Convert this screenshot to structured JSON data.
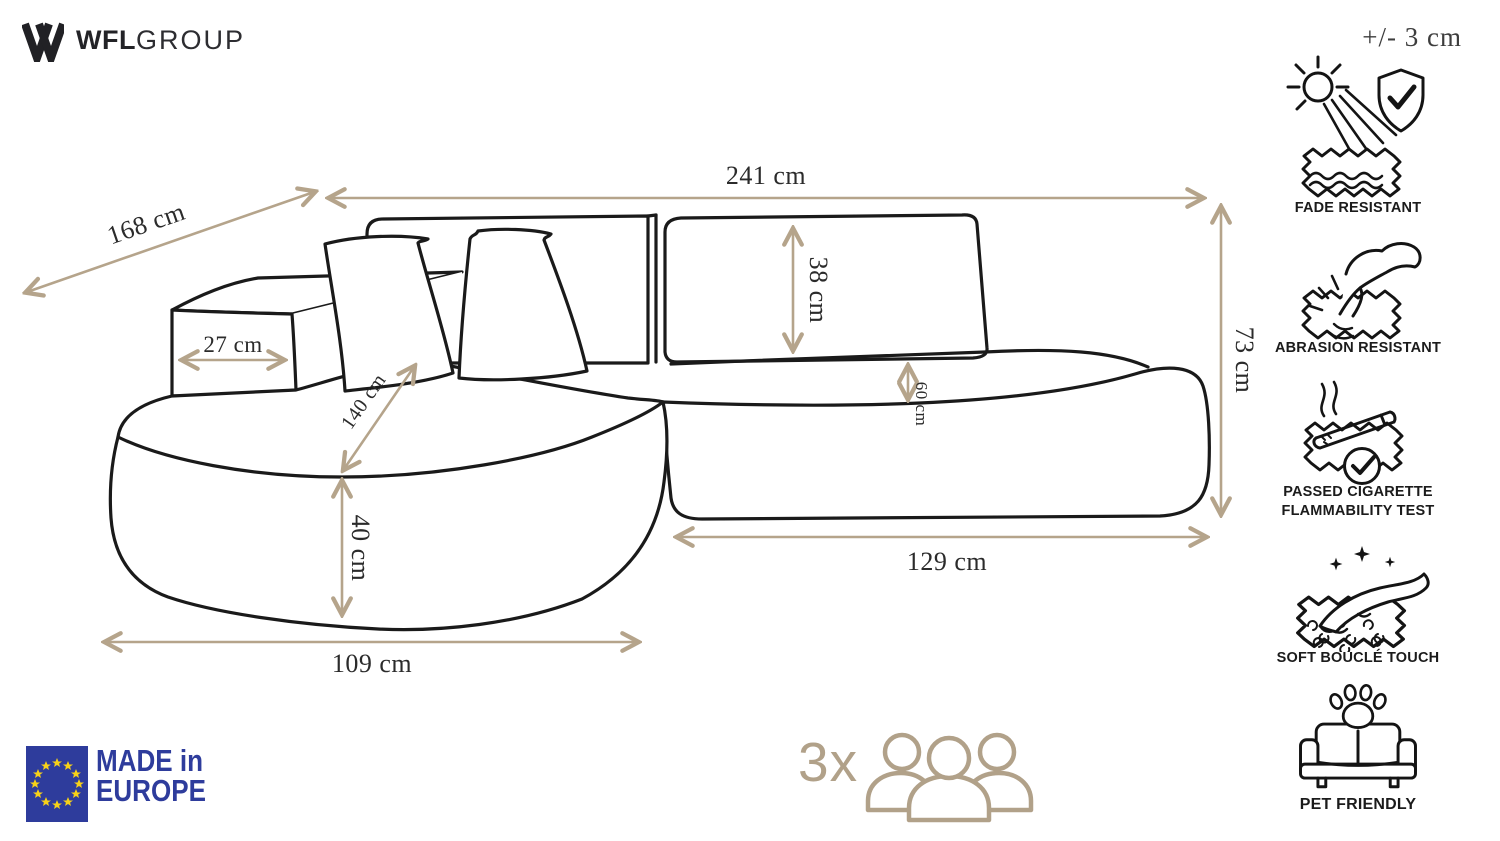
{
  "brand": {
    "name_bold": "WFL",
    "name_light": "GROUP",
    "mark": "w-logo"
  },
  "tolerance_note": "+/- 3 cm",
  "dimensions": [
    {
      "name": "total-width",
      "value": "241 cm"
    },
    {
      "name": "diagonal-depth",
      "value": "168 cm"
    },
    {
      "name": "armrest-width",
      "value": "27 cm"
    },
    {
      "name": "chaise-depth",
      "value": "140 cm"
    },
    {
      "name": "seat-height",
      "value": "40 cm"
    },
    {
      "name": "backrest-height",
      "value": "38 cm"
    },
    {
      "name": "seat-depth",
      "value": "60 cm"
    },
    {
      "name": "total-height",
      "value": "73 cm"
    },
    {
      "name": "seat-width",
      "value": "129 cm"
    },
    {
      "name": "chaise-width",
      "value": "109 cm"
    }
  ],
  "features": [
    {
      "id": "fade-resistant",
      "icon": "sun-shield-fabric-icon",
      "label": "FADE RESISTANT"
    },
    {
      "id": "abrasion-resistant",
      "icon": "hand-scratch-fabric-icon",
      "label": "ABRASION RESISTANT"
    },
    {
      "id": "cigarette-test",
      "icon": "cigarette-fabric-check-icon",
      "label_line1": "PASSED CIGARETTE",
      "label_line2": "FLAMMABILITY TEST"
    },
    {
      "id": "soft-boucle-touch",
      "icon": "hand-boucle-fabric-icon",
      "label": "SOFT BOUCLÉ TOUCH"
    },
    {
      "id": "pet-friendly",
      "icon": "sofa-paw-icon",
      "label": "PET FRIENDLY"
    }
  ],
  "made_in_badge": {
    "line1": "MADE in",
    "line2": "EUROPE"
  },
  "capacity": {
    "label": "3x",
    "icon": "three-people-icon"
  },
  "colors": {
    "accent_tan": "#b5a48b",
    "line_black": "#1a1a1a",
    "eu_blue": "#2e3c9c",
    "star_yellow": "#f7d118",
    "capacity_tan": "#b1a189"
  }
}
